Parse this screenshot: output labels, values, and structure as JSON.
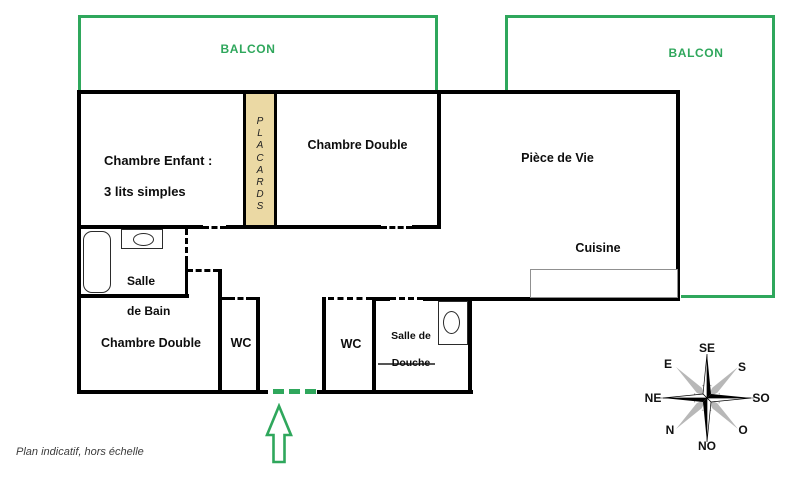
{
  "plan": {
    "note": "Plan indicatif, hors échelle",
    "colors": {
      "accent_green": "#2fa75c",
      "placard_fill": "#ebd9a4",
      "wall": "#000000",
      "counter_gray": "#909090",
      "compass_gray": "#b8b8b8"
    }
  },
  "balconies": [
    {
      "label": "BALCON"
    },
    {
      "label": "BALCON"
    }
  ],
  "rooms": {
    "chambre_enfant": {
      "line1": "Chambre Enfant :",
      "line2": "3 lits simples"
    },
    "chambre_double_top": {
      "label": "Chambre Double"
    },
    "piece_de_vie": {
      "label": "Pièce de Vie"
    },
    "cuisine": {
      "label": "Cuisine"
    },
    "placards": {
      "letters": [
        "P",
        "L",
        "A",
        "C",
        "A",
        "R",
        "D",
        "S"
      ]
    },
    "salle_de_bain": {
      "line1": "Salle",
      "line2": "de Bain"
    },
    "chambre_double_bottom": {
      "label": "Chambre Double"
    },
    "wc_left": {
      "label": "WC"
    },
    "wc_right": {
      "label": "WC"
    },
    "salle_de_douche": {
      "line1": "Salle de",
      "line2": "Douche"
    }
  },
  "compass": {
    "points": {
      "up": "SE",
      "upper_right": "S",
      "right": "SO",
      "lower_right": "O",
      "down": "NO",
      "lower_left": "N",
      "left": "NE",
      "upper_left": "E"
    }
  }
}
